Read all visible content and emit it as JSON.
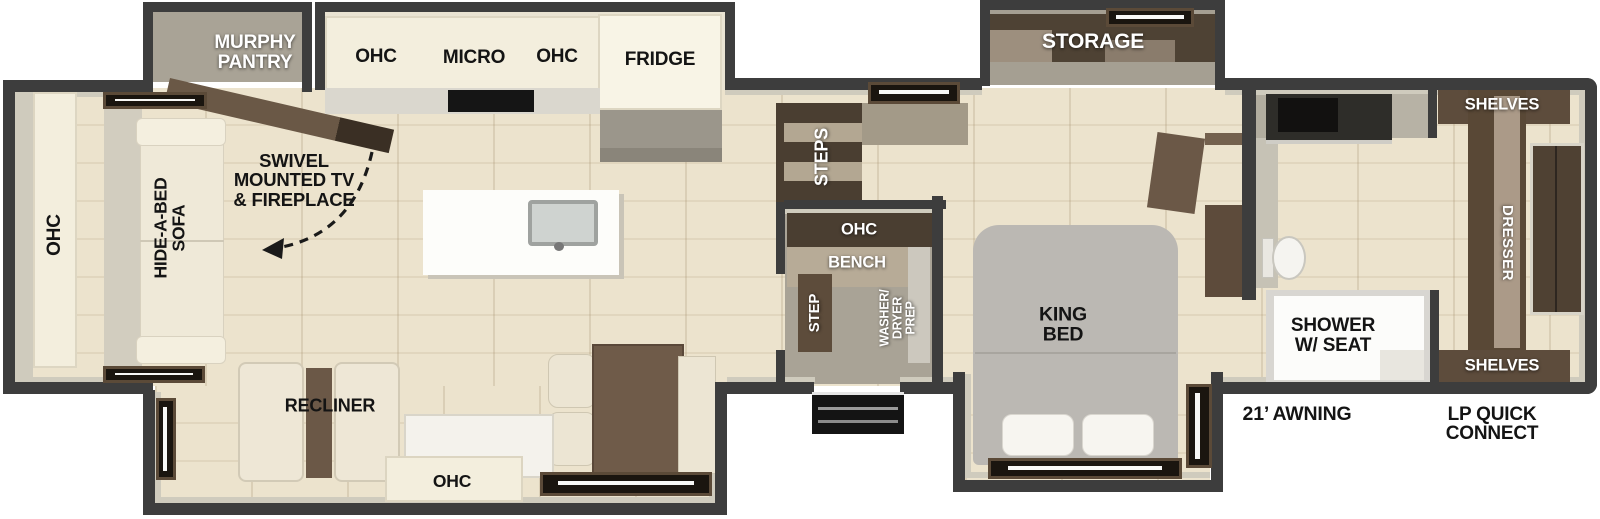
{
  "plan": {
    "type": "travel-trailer floorplan",
    "palette": {
      "wall": "#3d3d3d",
      "wood_floor": "#ece3cd",
      "gray_floor": "#a9a396",
      "cabinet_cream": "#f3eedd",
      "dark_brown": "#4a3e31",
      "mid_brown": "#5d4c3c",
      "bed_gray": "#bbb8b3",
      "appliance_black": "#151515",
      "label_white": "#ffffff",
      "label_black": "#141414"
    }
  },
  "labels": {
    "murphy_pantry": "MURPHY\nPANTRY",
    "kitchen_ohc_left": "OHC",
    "kitchen_micro": "MICRO",
    "kitchen_ohc_right": "OHC",
    "kitchen_fridge": "FRIDGE",
    "swivel_tv": "SWIVEL\nMOUNTED TV\n& FIREPLACE",
    "rear_ohc": "OHC",
    "hide_a_bed_sofa": "HIDE-A-BED\nSOFA",
    "storage": "STORAGE",
    "steps": "STEPS",
    "foyer_ohc": "OHC",
    "foyer_bench": "BENCH",
    "foyer_step": "STEP",
    "washer_dryer_prep": "WASHER/\nDRYER\nPREP",
    "king_bed": "KING\nBED",
    "recliner": "RECLINER",
    "slide_ohc": "OHC",
    "shower_w_seat": "SHOWER\nW/ SEAT",
    "shelves_top": "SHELVES",
    "dresser": "DRESSER",
    "shelves_bottom": "SHELVES",
    "awning": "21’ AWNING",
    "lp_quick_connect": "LP QUICK\nCONNECT"
  }
}
